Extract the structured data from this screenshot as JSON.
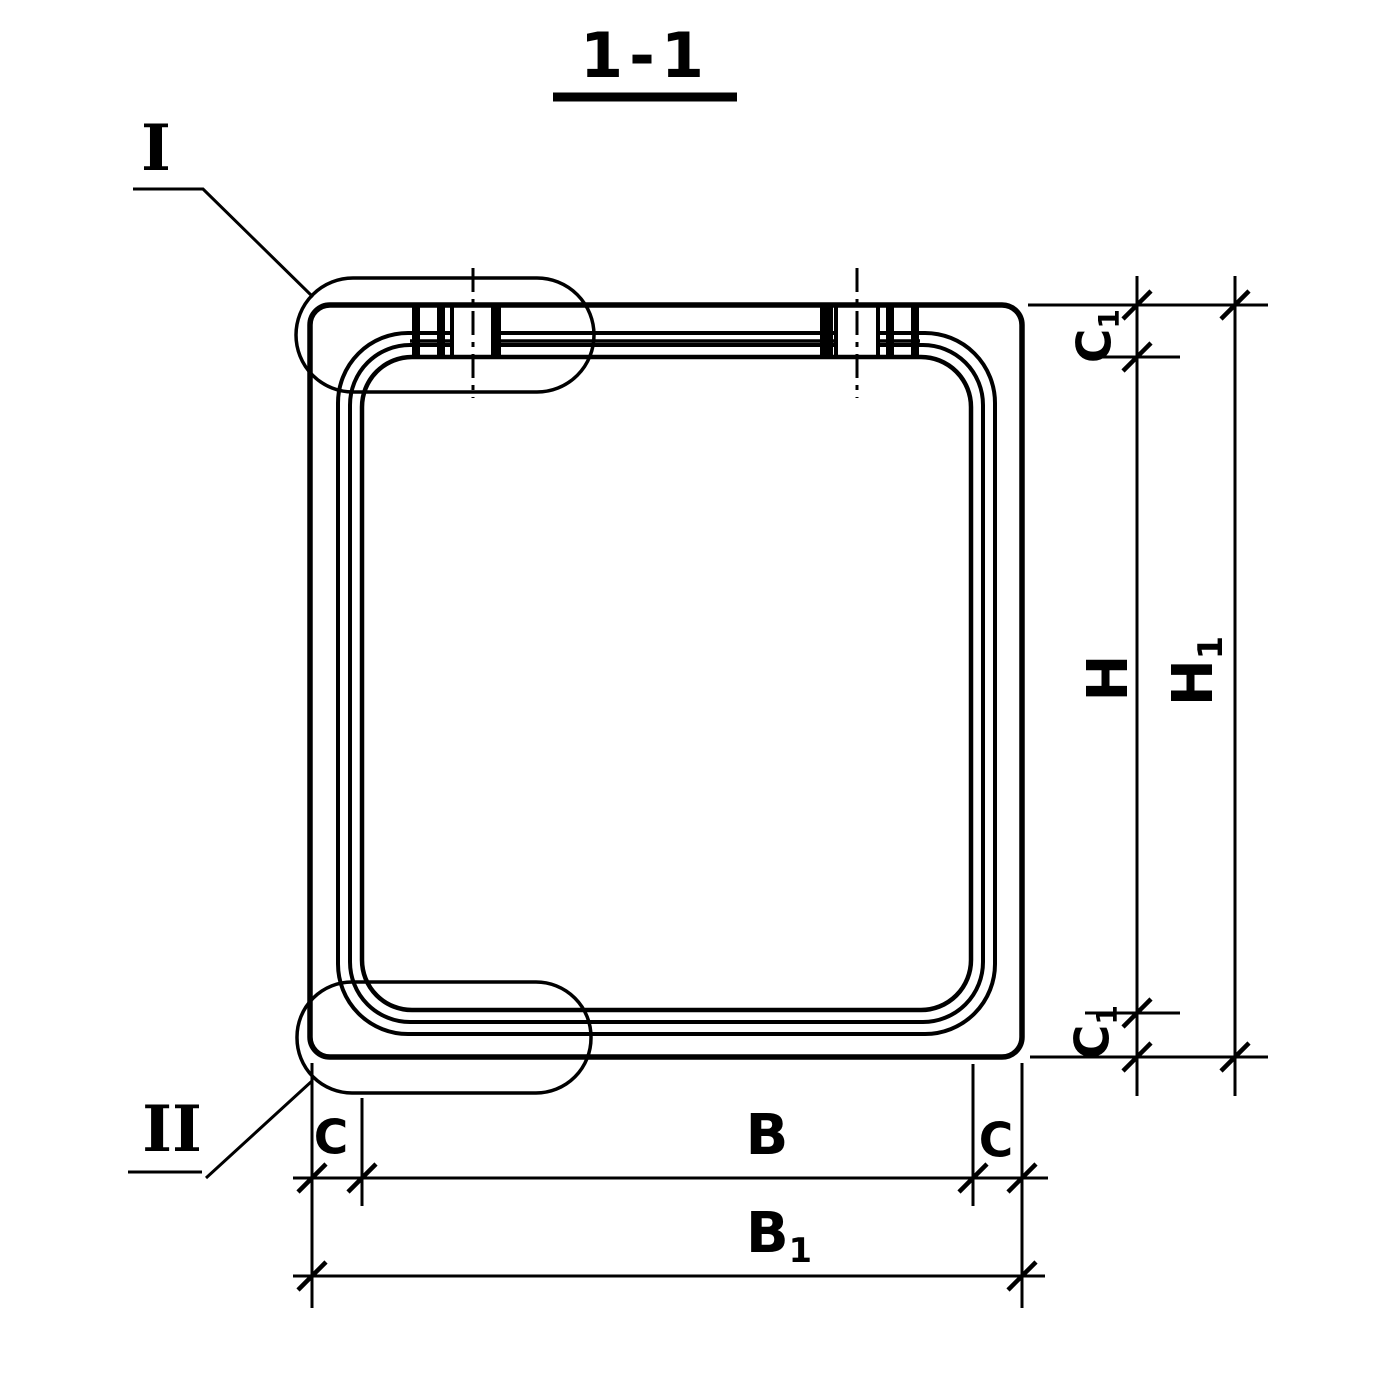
{
  "drawing": {
    "title": "1-1",
    "type_note": "section view of square frame / box element with jointed top slab"
  },
  "detail_markers": {
    "top_left": {
      "label": "I"
    },
    "bottom_left": {
      "label": "II"
    }
  },
  "dimensions": {
    "c1_top": {
      "main": "C",
      "sub": "1"
    },
    "h": {
      "main": "H",
      "sub": ""
    },
    "h1": {
      "main": "H",
      "sub": "1"
    },
    "c1_bottom": {
      "main": "C",
      "sub": "1"
    },
    "c_left": {
      "main": "C",
      "sub": ""
    },
    "b": {
      "main": "B",
      "sub": ""
    },
    "c_right": {
      "main": "C",
      "sub": ""
    },
    "b1": {
      "main": "B",
      "sub": "1"
    }
  },
  "colors": {
    "ink": "#000000",
    "background": "#ffffff"
  }
}
